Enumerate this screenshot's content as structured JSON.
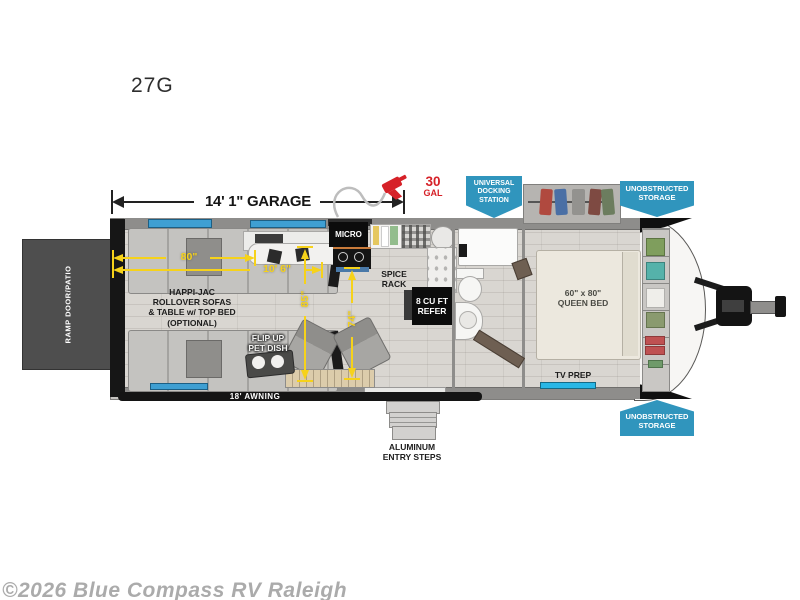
{
  "title": "27G",
  "watermark": "©2026 Blue Compass RV Raleigh",
  "callouts": {
    "garage_dimension": "14' 1\" GARAGE",
    "fuel_value": "30",
    "fuel_unit": "GAL",
    "docking_station": "UNIVERSAL\nDOCKING\nSTATION",
    "storage_top": "UNOBSTRUCTED\nSTORAGE",
    "storage_bottom": "UNOBSTRUCTED\nSTORAGE",
    "tv_prep": "TV PREP",
    "awning": "18' AWNING",
    "entry_steps": "ALUMINUM\nENTRY STEPS"
  },
  "rooms": {
    "ramp_door": "RAMP DOOR/PATIO",
    "sofas": "HAPPI-JAC\nROLLOVER SOFAS\n& TABLE w/ TOP BED\n(OPTIONAL)",
    "pet_dish": "FLIP UP\nPET DISH",
    "micro": "MICRO",
    "spice_rack": "SPICE\nRACK",
    "refrigerator": "8 CU FT\nREFER",
    "queen_bed": "60\" x 80\"\nQUEEN BED",
    "brand_logo": "MOMENTUM"
  },
  "measurements": {
    "sofa_width": "80\"",
    "garage_length_interior": "10' 6\"",
    "garage_clear_height_rear": "85\"",
    "garage_clear_height_front": "74\""
  },
  "colors": {
    "callout_cyan": "#3095bd",
    "dimension_yellow": "#f6d21a",
    "fuel_red": "#d62128",
    "watermark_gray": "#ababab"
  }
}
